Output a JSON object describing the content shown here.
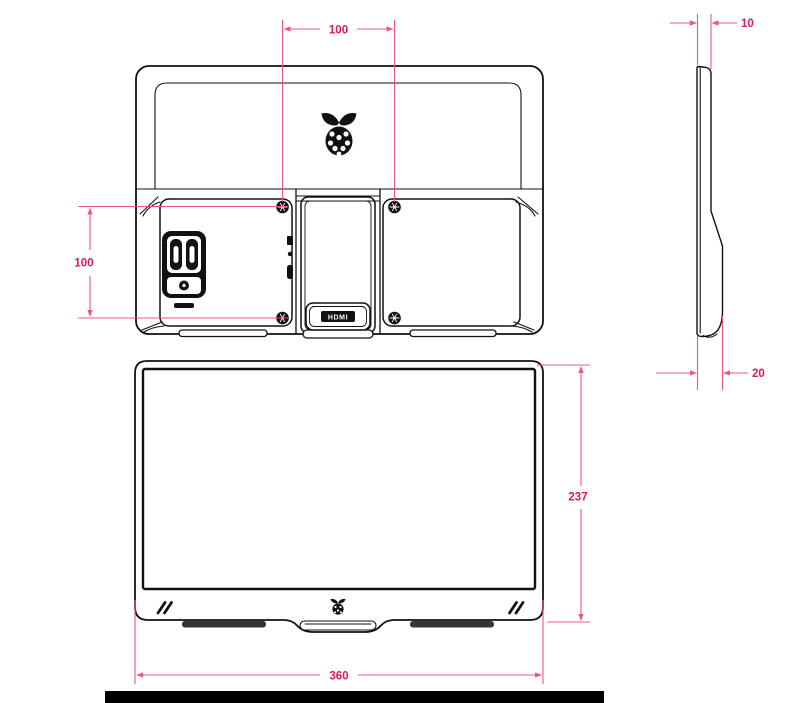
{
  "palette": {
    "ink": "#111111",
    "dim_line": "#f1547d",
    "dim_label": "#d81b5d",
    "background": "#ffffff",
    "scale_bar": "#000000"
  },
  "views": {
    "rear": {
      "vesa_width": "100",
      "vesa_height": "100",
      "hdmi_badge": "HDMI"
    },
    "side": {
      "top_thickness": "10",
      "base_thickness": "20"
    },
    "front": {
      "height": "237",
      "width": "360"
    }
  }
}
